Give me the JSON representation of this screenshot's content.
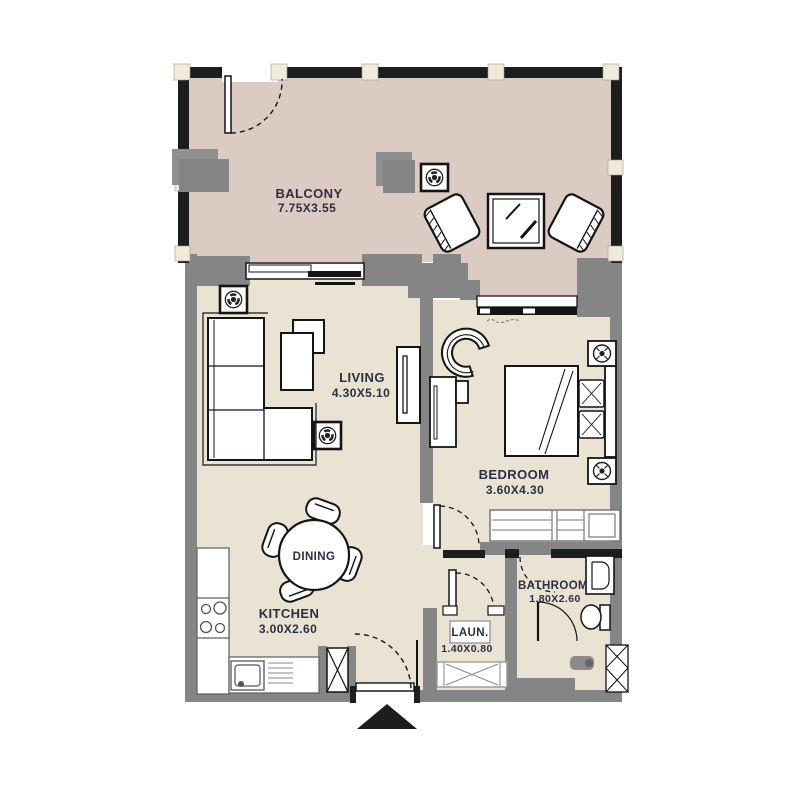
{
  "plan": {
    "type": "apartment-floor-plan",
    "entrance_marker": "entrance-arrow"
  },
  "rooms": [
    {
      "id": "balcony",
      "name": "BALCONY",
      "dims": "7.75X3.55"
    },
    {
      "id": "living",
      "name": "LIVING",
      "dims": "4.30X5.10"
    },
    {
      "id": "bedroom",
      "name": "BEDROOM",
      "dims": "3.60X4.30"
    },
    {
      "id": "dining",
      "name": "DINING",
      "dims": ""
    },
    {
      "id": "kitchen",
      "name": "KITCHEN",
      "dims": "3.00X2.60"
    },
    {
      "id": "bathroom",
      "name": "BATHROOM",
      "dims": "1.80X2.60"
    },
    {
      "id": "laundry",
      "name": "LAUN.",
      "dims": "1.40X0.80"
    }
  ],
  "colors": {
    "balcony_floor": "#dccbc3",
    "interior_floor": "#eae2d3",
    "wall_gray": "#858585",
    "wall_dark": "#1d1d1d",
    "post_cream": "#f1ead9",
    "label_text": "#2d2d44",
    "furniture_outline": "#141414",
    "background": "#ffffff"
  }
}
